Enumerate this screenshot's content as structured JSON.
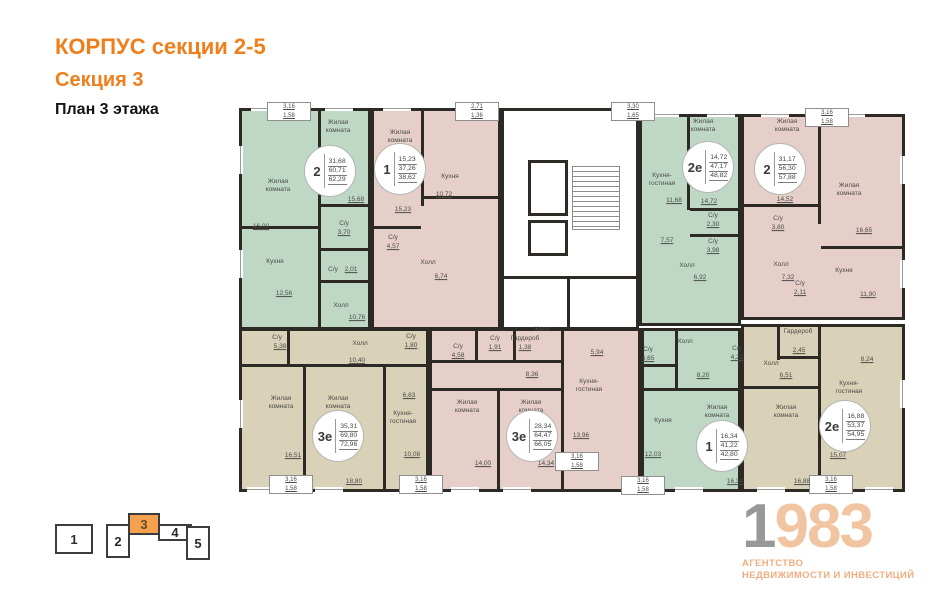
{
  "header": {
    "title": "КОРПУС секции 2-5",
    "section": "Секция 3",
    "floor": "План 3 этажа"
  },
  "colors": {
    "wall": "#2d2a26",
    "green": "#bfd8c6",
    "pink": "#e6cfc9",
    "beige": "#d9d1b8",
    "accent_orange": "#ef7e1b",
    "nav_highlight": "#f5a14d",
    "logo_gray": "#97989a",
    "logo_peach": "#f2c5a2"
  },
  "plan": {
    "apartments": [
      {
        "id": "2-rooms-top-left",
        "color": "green",
        "x": 2,
        "y": 8,
        "w": 132,
        "h": 222
      },
      {
        "id": "1-room-top-left",
        "color": "pink",
        "x": 134,
        "y": 8,
        "w": 130,
        "h": 222
      },
      {
        "id": "2e-top-right",
        "color": "green",
        "x": 402,
        "y": 14,
        "w": 102,
        "h": 212
      },
      {
        "id": "2-rooms-top-right",
        "color": "pink",
        "x": 504,
        "y": 14,
        "w": 164,
        "h": 206
      },
      {
        "id": "3e-bottom-left",
        "color": "beige",
        "x": 2,
        "y": 228,
        "w": 190,
        "h": 164
      },
      {
        "id": "3e-bottom-middle",
        "color": "pink",
        "x": 192,
        "y": 228,
        "w": 212,
        "h": 164
      },
      {
        "id": "1-room-bottom-right",
        "color": "green",
        "x": 404,
        "y": 228,
        "w": 100,
        "h": 164
      },
      {
        "id": "2e-bottom-right",
        "color": "beige",
        "x": 504,
        "y": 224,
        "w": 164,
        "h": 168
      }
    ],
    "core": {
      "rect": {
        "x": 264,
        "y": 8,
        "w": 138,
        "h": 222
      },
      "elevators": [
        {
          "x": 291,
          "y": 60,
          "w": 40,
          "h": 56
        },
        {
          "x": 291,
          "y": 120,
          "w": 40,
          "h": 36
        }
      ],
      "stairs": {
        "x": 335,
        "y": 66,
        "w": 48,
        "h": 64
      }
    },
    "walls": [
      {
        "x": 81,
        "y": 8,
        "w": 3,
        "h": 120
      },
      {
        "x": 2,
        "y": 126,
        "w": 80,
        "h": 3
      },
      {
        "x": 81,
        "y": 126,
        "w": 3,
        "h": 104
      },
      {
        "x": 84,
        "y": 104,
        "w": 50,
        "h": 3
      },
      {
        "x": 84,
        "y": 148,
        "w": 50,
        "h": 3
      },
      {
        "x": 84,
        "y": 180,
        "w": 50,
        "h": 3
      },
      {
        "x": 184,
        "y": 8,
        "w": 3,
        "h": 98
      },
      {
        "x": 187,
        "y": 96,
        "w": 77,
        "h": 3
      },
      {
        "x": 134,
        "y": 126,
        "w": 50,
        "h": 3
      },
      {
        "x": 450,
        "y": 14,
        "w": 3,
        "h": 96
      },
      {
        "x": 453,
        "y": 108,
        "w": 51,
        "h": 3
      },
      {
        "x": 453,
        "y": 134,
        "w": 51,
        "h": 3
      },
      {
        "x": 581,
        "y": 14,
        "w": 3,
        "h": 110
      },
      {
        "x": 504,
        "y": 104,
        "w": 77,
        "h": 3
      },
      {
        "x": 584,
        "y": 146,
        "w": 84,
        "h": 3
      },
      {
        "x": 2,
        "y": 264,
        "w": 190,
        "h": 3
      },
      {
        "x": 66,
        "y": 267,
        "w": 3,
        "h": 125
      },
      {
        "x": 146,
        "y": 267,
        "w": 3,
        "h": 125
      },
      {
        "x": 50,
        "y": 228,
        "w": 3,
        "h": 38
      },
      {
        "x": 192,
        "y": 260,
        "w": 134,
        "h": 3
      },
      {
        "x": 260,
        "y": 290,
        "w": 3,
        "h": 102
      },
      {
        "x": 324,
        "y": 228,
        "w": 3,
        "h": 164
      },
      {
        "x": 238,
        "y": 228,
        "w": 3,
        "h": 34
      },
      {
        "x": 276,
        "y": 228,
        "w": 3,
        "h": 34
      },
      {
        "x": 192,
        "y": 288,
        "w": 132,
        "h": 3
      },
      {
        "x": 404,
        "y": 288,
        "w": 100,
        "h": 3
      },
      {
        "x": 438,
        "y": 228,
        "w": 3,
        "h": 62
      },
      {
        "x": 404,
        "y": 264,
        "w": 36,
        "h": 3
      },
      {
        "x": 581,
        "y": 224,
        "w": 3,
        "h": 168
      },
      {
        "x": 504,
        "y": 286,
        "w": 77,
        "h": 3
      },
      {
        "x": 540,
        "y": 224,
        "w": 3,
        "h": 36
      },
      {
        "x": 540,
        "y": 256,
        "w": 43,
        "h": 3
      },
      {
        "x": 264,
        "y": 176,
        "w": 138,
        "h": 3
      },
      {
        "x": 330,
        "y": 179,
        "w": 3,
        "h": 51
      }
    ],
    "windows_h": [
      {
        "x": 14,
        "y": 6
      },
      {
        "x": 88,
        "y": 6
      },
      {
        "x": 146,
        "y": 6
      },
      {
        "x": 414,
        "y": 12
      },
      {
        "x": 470,
        "y": 12
      },
      {
        "x": 524,
        "y": 12
      },
      {
        "x": 600,
        "y": 12
      },
      {
        "x": 10,
        "y": 387
      },
      {
        "x": 78,
        "y": 387
      },
      {
        "x": 214,
        "y": 387
      },
      {
        "x": 266,
        "y": 387
      },
      {
        "x": 438,
        "y": 387
      },
      {
        "x": 520,
        "y": 387
      },
      {
        "x": 628,
        "y": 387
      }
    ],
    "windows_v": [
      {
        "x": 1,
        "y": 46
      },
      {
        "x": 1,
        "y": 150
      },
      {
        "x": 1,
        "y": 300
      },
      {
        "x": 663,
        "y": 56
      },
      {
        "x": 663,
        "y": 160
      },
      {
        "x": 663,
        "y": 280
      }
    ],
    "badges": [
      {
        "type": "2",
        "values": [
          "31,68",
          "60,71",
          "62,29"
        ],
        "x": 93,
        "y": 71
      },
      {
        "type": "1",
        "values": [
          "15,23",
          "37,26",
          "38,62"
        ],
        "x": 163,
        "y": 69
      },
      {
        "type": "2е",
        "values": [
          "14,72",
          "47,17",
          "48,82"
        ],
        "x": 471,
        "y": 67
      },
      {
        "type": "2",
        "values": [
          "31,17",
          "56,30",
          "57,88"
        ],
        "x": 543,
        "y": 69
      },
      {
        "type": "3е",
        "values": [
          "35,31",
          "69,80",
          "72,96"
        ],
        "x": 101,
        "y": 336
      },
      {
        "type": "3е",
        "values": [
          "28,34",
          "64,47",
          "66,05"
        ],
        "x": 295,
        "y": 336
      },
      {
        "type": "1",
        "values": [
          "16,34",
          "41,22",
          "42,80"
        ],
        "x": 485,
        "y": 346
      },
      {
        "type": "2е",
        "values": [
          "16,88",
          "53,37",
          "54,95"
        ],
        "x": 608,
        "y": 326
      }
    ],
    "balconies": [
      {
        "a": "3,16",
        "b": "1,58",
        "x": 30,
        "y": 2,
        "w": 44,
        "h": 19
      },
      {
        "a": "2,71",
        "b": "1,36",
        "x": 218,
        "y": 2,
        "w": 44,
        "h": 19
      },
      {
        "a": "3,30",
        "b": "1,65",
        "x": 374,
        "y": 2,
        "w": 44,
        "h": 19
      },
      {
        "a": "3,16",
        "b": "1,58",
        "x": 568,
        "y": 8,
        "w": 44,
        "h": 19
      },
      {
        "a": "3,16",
        "b": "1,58",
        "x": 32,
        "y": 375,
        "w": 44,
        "h": 19
      },
      {
        "a": "3,16",
        "b": "1,58",
        "x": 162,
        "y": 375,
        "w": 44,
        "h": 19
      },
      {
        "a": "3,16",
        "b": "1,58",
        "x": 318,
        "y": 352,
        "w": 44,
        "h": 19
      },
      {
        "a": "3,16",
        "b": "1,58",
        "x": 384,
        "y": 376,
        "w": 44,
        "h": 19
      },
      {
        "a": "3,16",
        "b": "1,58",
        "x": 572,
        "y": 375,
        "w": 44,
        "h": 19
      }
    ],
    "labels": [
      {
        "t": "Жилая\nкомната",
        "x": 41,
        "y": 86
      },
      {
        "t": "16,00",
        "x": 24,
        "y": 127,
        "u": 1
      },
      {
        "t": "Кухня",
        "x": 38,
        "y": 162
      },
      {
        "t": "12,56",
        "x": 47,
        "y": 194,
        "u": 1
      },
      {
        "t": "Жилая\nкомната",
        "x": 101,
        "y": 27
      },
      {
        "t": "15,68",
        "x": 119,
        "y": 100,
        "u": 1
      },
      {
        "t": "С/у",
        "x": 107,
        "y": 124
      },
      {
        "t": "3,70",
        "x": 107,
        "y": 133,
        "u": 1
      },
      {
        "t": "С/у",
        "x": 96,
        "y": 170
      },
      {
        "t": "2,01",
        "x": 114,
        "y": 170,
        "u": 1
      },
      {
        "t": "Холл",
        "x": 104,
        "y": 206
      },
      {
        "t": "10,76",
        "x": 120,
        "y": 218,
        "u": 1
      },
      {
        "t": "Жилая\nкомната",
        "x": 163,
        "y": 37
      },
      {
        "t": "15,23",
        "x": 166,
        "y": 110,
        "u": 1
      },
      {
        "t": "Кухня",
        "x": 213,
        "y": 77
      },
      {
        "t": "10,72",
        "x": 207,
        "y": 95,
        "u": 1
      },
      {
        "t": "С/у",
        "x": 156,
        "y": 138
      },
      {
        "t": "4,57",
        "x": 156,
        "y": 147,
        "u": 1
      },
      {
        "t": "Холл",
        "x": 191,
        "y": 163
      },
      {
        "t": "6,74",
        "x": 204,
        "y": 177,
        "u": 1
      },
      {
        "t": "Кухня-\nгостиная",
        "x": 425,
        "y": 80
      },
      {
        "t": "11,68",
        "x": 437,
        "y": 101,
        "u": 1
      },
      {
        "t": "7,57",
        "x": 430,
        "y": 141,
        "u": 1
      },
      {
        "t": "Холл",
        "x": 450,
        "y": 166
      },
      {
        "t": "6,92",
        "x": 463,
        "y": 178,
        "u": 1
      },
      {
        "t": "Жилая\nкомната",
        "x": 466,
        "y": 26
      },
      {
        "t": "14,72",
        "x": 472,
        "y": 102,
        "u": 1
      },
      {
        "t": "С/у",
        "x": 476,
        "y": 116
      },
      {
        "t": "2,30",
        "x": 476,
        "y": 125,
        "u": 1
      },
      {
        "t": "С/у",
        "x": 476,
        "y": 142
      },
      {
        "t": "3,98",
        "x": 476,
        "y": 151,
        "u": 1
      },
      {
        "t": "Жилая\nкомната",
        "x": 550,
        "y": 26
      },
      {
        "t": "14,52",
        "x": 548,
        "y": 100,
        "u": 1
      },
      {
        "t": "Жилая\nкомната",
        "x": 612,
        "y": 90
      },
      {
        "t": "16,65",
        "x": 627,
        "y": 131,
        "u": 1
      },
      {
        "t": "С/у",
        "x": 541,
        "y": 119
      },
      {
        "t": "3,80",
        "x": 541,
        "y": 128,
        "u": 1
      },
      {
        "t": "Холл",
        "x": 544,
        "y": 165
      },
      {
        "t": "7,32",
        "x": 551,
        "y": 178,
        "u": 1
      },
      {
        "t": "С/у",
        "x": 563,
        "y": 184
      },
      {
        "t": "2,11",
        "x": 563,
        "y": 193,
        "u": 1
      },
      {
        "t": "Кухня",
        "x": 607,
        "y": 171
      },
      {
        "t": "11,90",
        "x": 631,
        "y": 195,
        "u": 1
      },
      {
        "t": "С/у",
        "x": 40,
        "y": 238
      },
      {
        "t": "5,38",
        "x": 43,
        "y": 247,
        "u": 1
      },
      {
        "t": "Холл",
        "x": 123,
        "y": 244
      },
      {
        "t": "10,40",
        "x": 120,
        "y": 261,
        "u": 1
      },
      {
        "t": "Жилая\nкомната",
        "x": 44,
        "y": 303
      },
      {
        "t": "16,51",
        "x": 56,
        "y": 356,
        "u": 1
      },
      {
        "t": "Жилая\nкомната",
        "x": 101,
        "y": 303
      },
      {
        "t": "18,80",
        "x": 117,
        "y": 382,
        "u": 1
      },
      {
        "t": "Кухня-\nгостиная",
        "x": 166,
        "y": 318
      },
      {
        "t": "10,08",
        "x": 175,
        "y": 355,
        "u": 1
      },
      {
        "t": "6,83",
        "x": 172,
        "y": 296,
        "u": 1
      },
      {
        "t": "С/у",
        "x": 174,
        "y": 237
      },
      {
        "t": "1,80",
        "x": 174,
        "y": 246,
        "u": 1
      },
      {
        "t": "С/у",
        "x": 221,
        "y": 247
      },
      {
        "t": "4,58",
        "x": 221,
        "y": 256,
        "u": 1
      },
      {
        "t": "С/у",
        "x": 258,
        "y": 239
      },
      {
        "t": "1,91",
        "x": 258,
        "y": 248,
        "u": 1
      },
      {
        "t": "Гардероб",
        "x": 288,
        "y": 239
      },
      {
        "t": "1,38",
        "x": 288,
        "y": 248,
        "u": 1
      },
      {
        "t": "Холл",
        "x": 305,
        "y": 230
      },
      {
        "t": "8,36",
        "x": 295,
        "y": 275,
        "u": 1
      },
      {
        "t": "5,94",
        "x": 360,
        "y": 253,
        "u": 1
      },
      {
        "t": "Кухня-\nгостиная",
        "x": 352,
        "y": 286
      },
      {
        "t": "13,96",
        "x": 344,
        "y": 336,
        "u": 1
      },
      {
        "t": "Жилая\nкомната",
        "x": 230,
        "y": 307
      },
      {
        "t": "14,00",
        "x": 246,
        "y": 364,
        "u": 1
      },
      {
        "t": "Жилая\nкомната",
        "x": 294,
        "y": 307
      },
      {
        "t": "14,34",
        "x": 309,
        "y": 364,
        "u": 1
      },
      {
        "t": "Холл",
        "x": 448,
        "y": 242
      },
      {
        "t": "8,20",
        "x": 466,
        "y": 276,
        "u": 1
      },
      {
        "t": "С/у",
        "x": 411,
        "y": 250
      },
      {
        "t": "4,65",
        "x": 411,
        "y": 259,
        "u": 1
      },
      {
        "t": "Кухня",
        "x": 426,
        "y": 321
      },
      {
        "t": "12,03",
        "x": 416,
        "y": 355,
        "u": 1
      },
      {
        "t": "Жилая\nкомната",
        "x": 480,
        "y": 312
      },
      {
        "t": "16,34",
        "x": 498,
        "y": 382,
        "u": 1
      },
      {
        "t": "Гардероб",
        "x": 561,
        "y": 232
      },
      {
        "t": "2,45",
        "x": 562,
        "y": 251,
        "u": 1
      },
      {
        "t": "С/у",
        "x": 500,
        "y": 249
      },
      {
        "t": "4,22",
        "x": 500,
        "y": 258,
        "u": 1
      },
      {
        "t": "Холл",
        "x": 534,
        "y": 264
      },
      {
        "t": "6,51",
        "x": 549,
        "y": 276,
        "u": 1
      },
      {
        "t": "Кухня-\nгостиная",
        "x": 612,
        "y": 288
      },
      {
        "t": "8,24",
        "x": 630,
        "y": 260,
        "u": 1
      },
      {
        "t": "15,07",
        "x": 601,
        "y": 356,
        "u": 1
      },
      {
        "t": "Жилая\nкомната",
        "x": 549,
        "y": 312
      },
      {
        "t": "16,88",
        "x": 565,
        "y": 382,
        "u": 1
      }
    ]
  },
  "section_nav": {
    "blocks": [
      {
        "label": "1",
        "x": 55,
        "y": 524,
        "w": 38,
        "h": 30,
        "active": false
      },
      {
        "label": "2",
        "x": 106,
        "y": 524,
        "w": 24,
        "h": 34,
        "active": false
      },
      {
        "label": "3",
        "x": 128,
        "y": 513,
        "w": 32,
        "h": 22,
        "active": true
      },
      {
        "label": "4",
        "x": 158,
        "y": 524,
        "w": 34,
        "h": 17,
        "active": false
      },
      {
        "label": "5",
        "x": 186,
        "y": 526,
        "w": 24,
        "h": 34,
        "active": false
      }
    ]
  },
  "logo": {
    "digit_gray": "1",
    "digits_peach": "983",
    "line1": "АГЕНТСТВО",
    "line2": "НЕДВИЖИМОСТИ И ИНВЕСТИЦИЙ"
  }
}
